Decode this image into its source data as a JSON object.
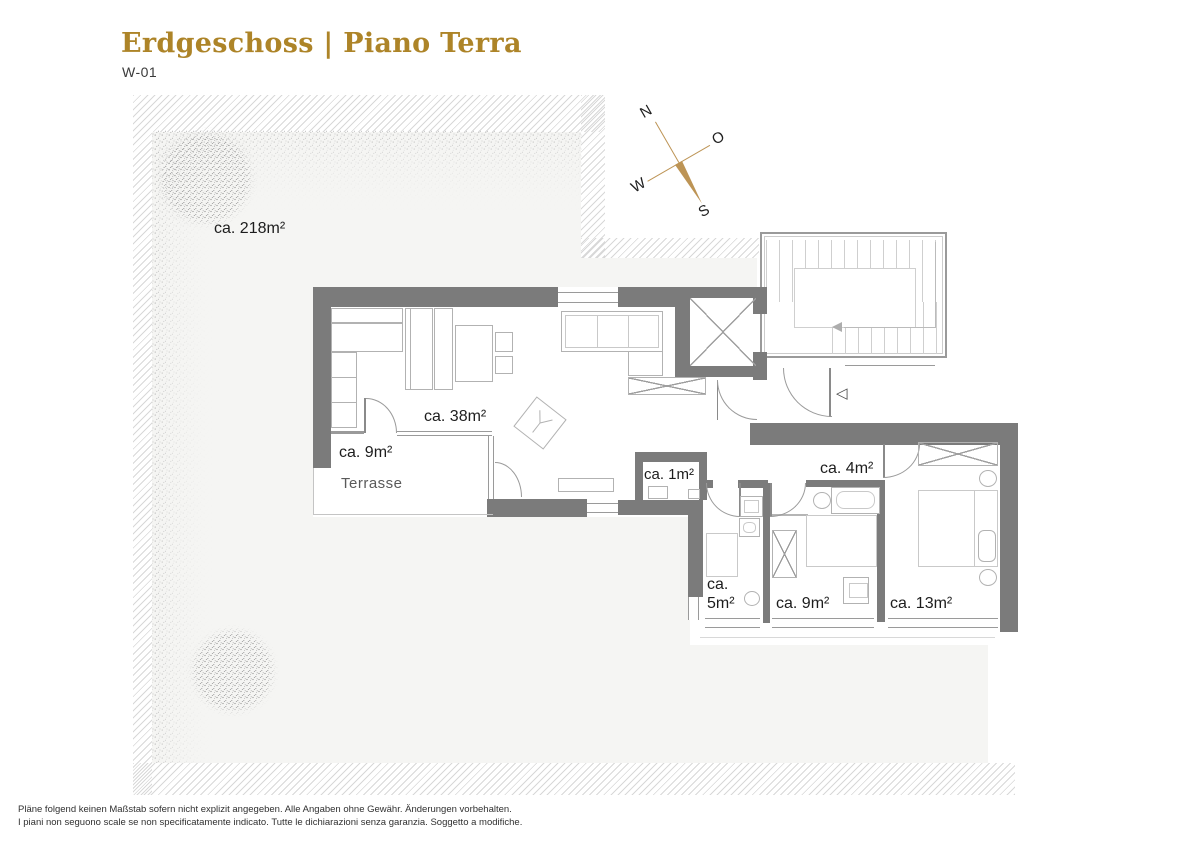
{
  "header": {
    "title": "Erdgeschoss | Piano Terra",
    "unit": "W-01"
  },
  "compass": {
    "north": "N",
    "east": "O",
    "south": "S",
    "west": "W"
  },
  "plan": {
    "garden": {
      "area_label": "ca. 218m²"
    },
    "rooms": [
      {
        "id": "living-dining",
        "area_label": "ca. 38m²"
      },
      {
        "id": "terrace",
        "area_label": "ca. 9m²",
        "name": "Terrasse"
      },
      {
        "id": "storage",
        "area_label": "ca. 1m²"
      },
      {
        "id": "bathroom-large",
        "area_label": "ca. 4m²"
      },
      {
        "id": "bathroom-small",
        "area_label_line1": "ca.",
        "area_label_line2": "5m²"
      },
      {
        "id": "bedroom-small",
        "area_label": "ca. 9m²"
      },
      {
        "id": "bedroom-large",
        "area_label": "ca. 13m²"
      }
    ]
  },
  "footer": {
    "line1": "Pläne folgend keinen Maßstab sofern nicht explizit angegeben. Alle Angaben ohne Gewähr. Änderungen vorbehalten.",
    "line2": "I piani non seguono scale se non specificatamente indicato. Tutte le dichiarazioni senza garanzia. Soggetto a modifiche."
  },
  "colors": {
    "accent_gold": "#ad8428",
    "compass_gold": "#bd9455",
    "wall_gray": "#7b7b7b",
    "garden_fill": "#f5f5f3",
    "hatch_line": "#d8d8d8"
  }
}
